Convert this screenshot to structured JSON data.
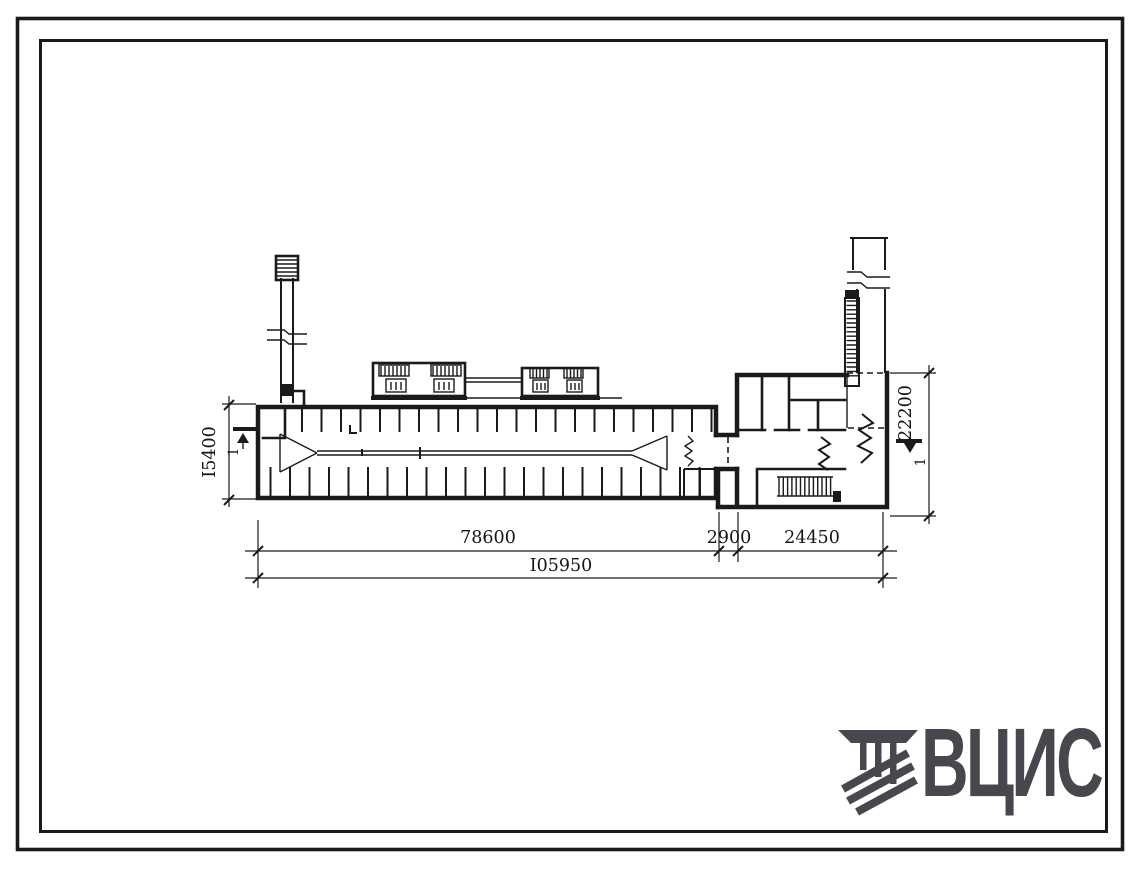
{
  "page": {
    "background": "#ffffff",
    "ink_color": "#1a1a1a"
  },
  "drawing": {
    "dims": {
      "span_left": "78600",
      "span_link": "2900",
      "span_right": "24450",
      "total_length": "I05950",
      "hall_width": "I5400",
      "annex_width": "22200"
    },
    "section_marks": {
      "left_label": "1",
      "right_label": "1"
    }
  },
  "logo": {
    "text": "ВЦИС",
    "color": "#47474d",
    "icon": "hatched-beams-logo-icon"
  }
}
